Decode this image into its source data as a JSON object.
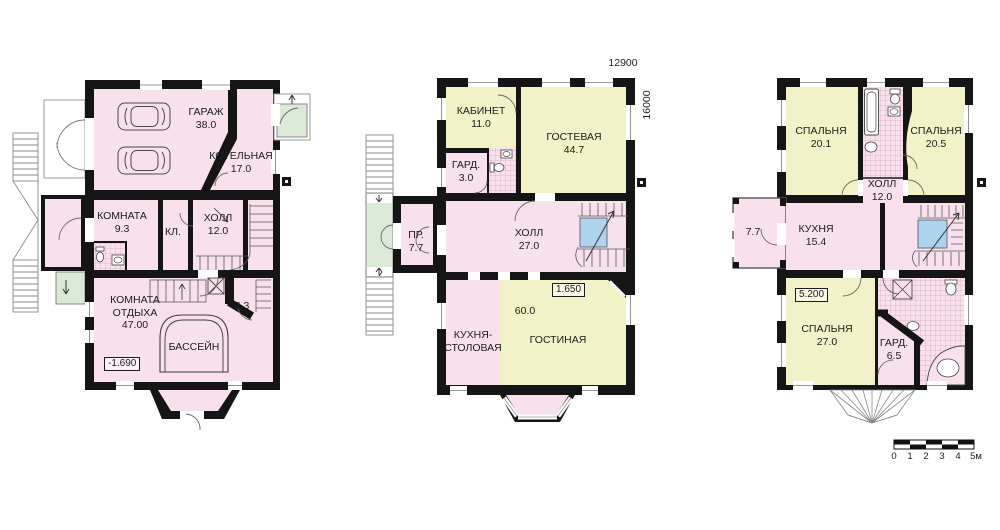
{
  "colors": {
    "wall": "#151515",
    "room_pink": "#f8e1ec",
    "room_yellow": "#f2f2c8",
    "porch_green": "#dbe9d7",
    "shaft_blue": "#aed3ef"
  },
  "plans": [
    {
      "id": "basement",
      "elevation": "-1.690",
      "rooms": [
        {
          "label": "ГАРАЖ",
          "area": "38.0"
        },
        {
          "label": "КОТЕЛЬНАЯ",
          "area": "17.0"
        },
        {
          "label": "КОМНАТА",
          "area": "9.3"
        },
        {
          "label": "КЛ.",
          "area": ""
        },
        {
          "label": "ХОЛЛ",
          "area": "12.0"
        },
        {
          "label": "КОМНАТА ОТДЫХА",
          "area": "47.00"
        },
        {
          "label": "БАССЕЙН",
          "area": ""
        },
        {
          "label": "",
          "area": "6.3"
        }
      ]
    },
    {
      "id": "first-floor",
      "elevation": "1.650",
      "dimensions": {
        "width_mm": "12900",
        "height_mm": "16000"
      },
      "rooms": [
        {
          "label": "КАБИНЕТ",
          "area": "11.0"
        },
        {
          "label": "ГОСТЕВАЯ",
          "area": "44.7"
        },
        {
          "label": "ГАРД.",
          "area": "3.0"
        },
        {
          "label": "ПР.",
          "area": "7.7"
        },
        {
          "label": "ХОЛЛ",
          "area": "27.0"
        },
        {
          "label": "КУХНЯ-СТОЛОВАЯ",
          "area": ""
        },
        {
          "label": "ГОСТИНАЯ",
          "area": "60.0"
        }
      ]
    },
    {
      "id": "second-floor",
      "elevation": "5.200",
      "rooms": [
        {
          "label": "СПАЛЬНЯ",
          "area": "20.1"
        },
        {
          "label": "СПАЛЬНЯ",
          "area": "20.5"
        },
        {
          "label": "ХОЛЛ",
          "area": "12.0"
        },
        {
          "label": "",
          "area": "7.7"
        },
        {
          "label": "КУХНЯ",
          "area": "15.4"
        },
        {
          "label": "СПАЛЬНЯ",
          "area": "27.0"
        },
        {
          "label": "ГАРД.",
          "area": "6.5"
        }
      ]
    }
  ],
  "scale_bar": {
    "labels": [
      "0",
      "1",
      "2",
      "3",
      "4",
      "5м"
    ]
  }
}
